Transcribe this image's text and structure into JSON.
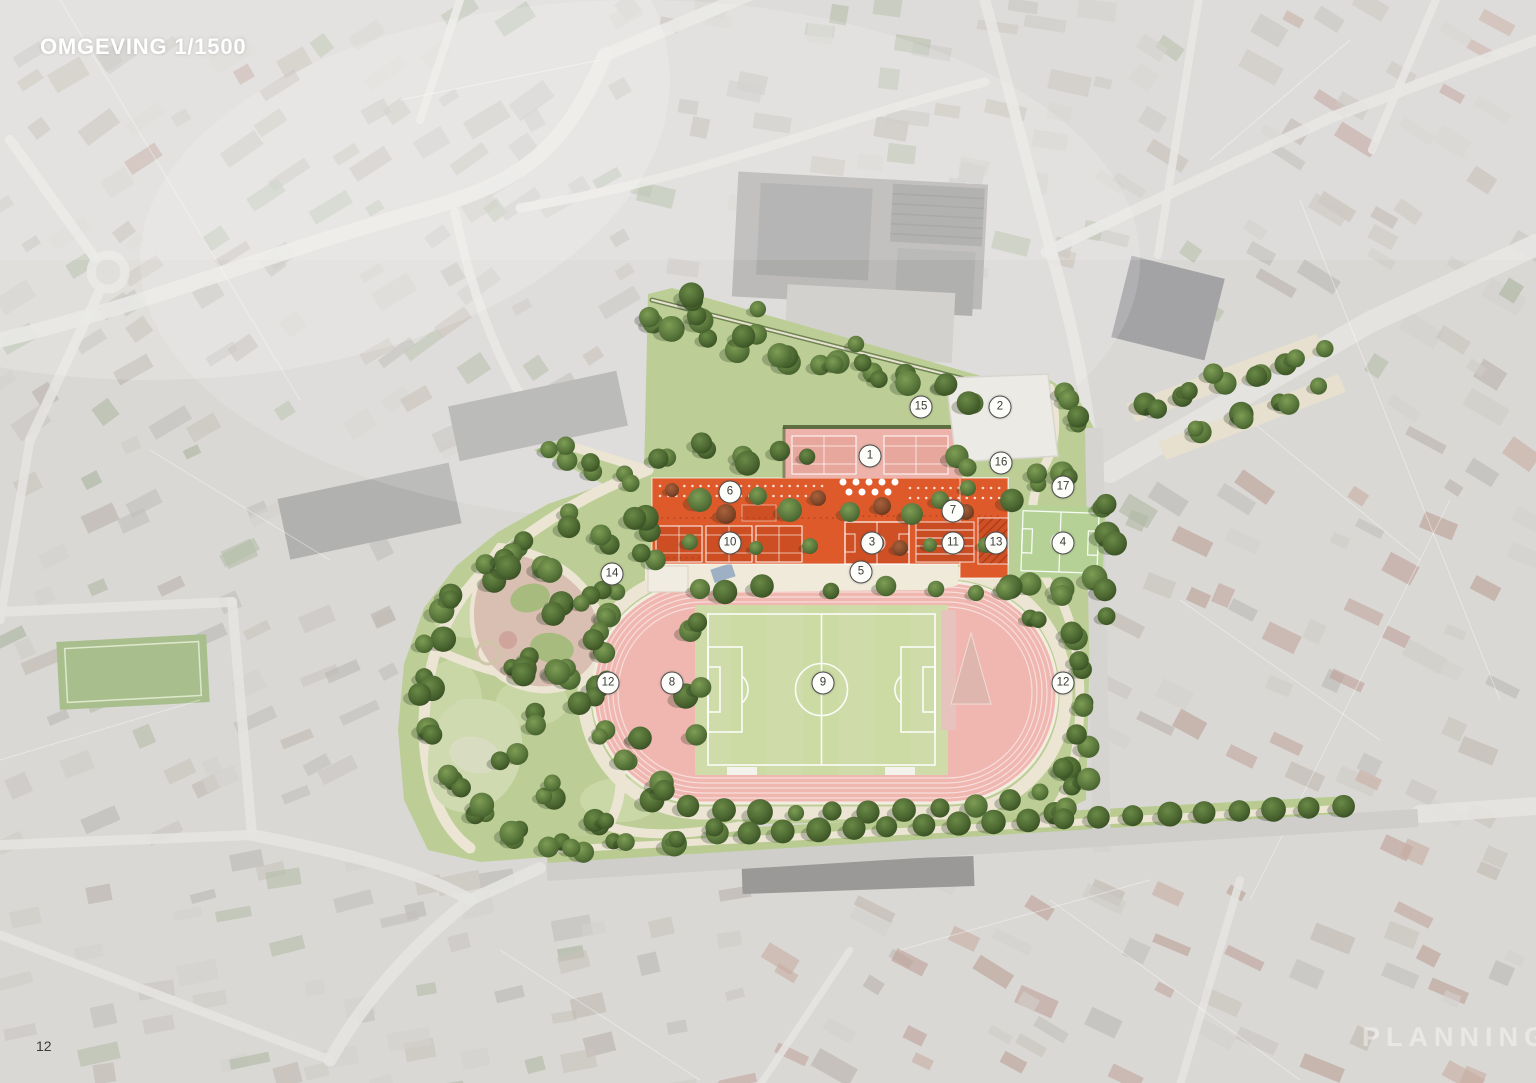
{
  "page": {
    "title": "OMGEVING 1/1500",
    "page_number": "12",
    "watermark": "PLANNING"
  },
  "colors": {
    "accent_orange": "#DF5A2B",
    "roof_court_orange": "#CC4E22",
    "track_pink": "#EFB7B0",
    "pitch_green": "#CCDAA4",
    "park_green": "#BCCE96",
    "tennis_zone_pink": "#EDB3AA",
    "white_pad": "#ECEAE4",
    "small_field_green": "#B6D296",
    "path_beige": "#ECE5D4",
    "marker_bg": "#FDFDFA",
    "marker_border": "#4C4C4A"
  },
  "map": {
    "markers": [
      {
        "id": "1",
        "label": "1",
        "x": 870,
        "y": 456
      },
      {
        "id": "2",
        "label": "2",
        "x": 1000,
        "y": 407
      },
      {
        "id": "3",
        "label": "3",
        "x": 872,
        "y": 543
      },
      {
        "id": "4",
        "label": "4",
        "x": 1063,
        "y": 543
      },
      {
        "id": "5",
        "label": "5",
        "x": 861,
        "y": 572
      },
      {
        "id": "6",
        "label": "6",
        "x": 730,
        "y": 492
      },
      {
        "id": "7",
        "label": "7",
        "x": 953,
        "y": 511
      },
      {
        "id": "8",
        "label": "8",
        "x": 672,
        "y": 683
      },
      {
        "id": "9",
        "label": "9",
        "x": 823,
        "y": 683
      },
      {
        "id": "10",
        "label": "10",
        "x": 730,
        "y": 543
      },
      {
        "id": "11",
        "label": "11",
        "x": 953,
        "y": 543
      },
      {
        "id": "12a",
        "label": "12",
        "x": 608,
        "y": 683
      },
      {
        "id": "12b",
        "label": "12",
        "x": 1063,
        "y": 683
      },
      {
        "id": "13",
        "label": "13",
        "x": 996,
        "y": 543
      },
      {
        "id": "14",
        "label": "14",
        "x": 612,
        "y": 574
      },
      {
        "id": "15",
        "label": "15",
        "x": 921,
        "y": 407
      },
      {
        "id": "16",
        "label": "16",
        "x": 1001,
        "y": 463
      },
      {
        "id": "17",
        "label": "17",
        "x": 1063,
        "y": 487
      }
    ]
  }
}
